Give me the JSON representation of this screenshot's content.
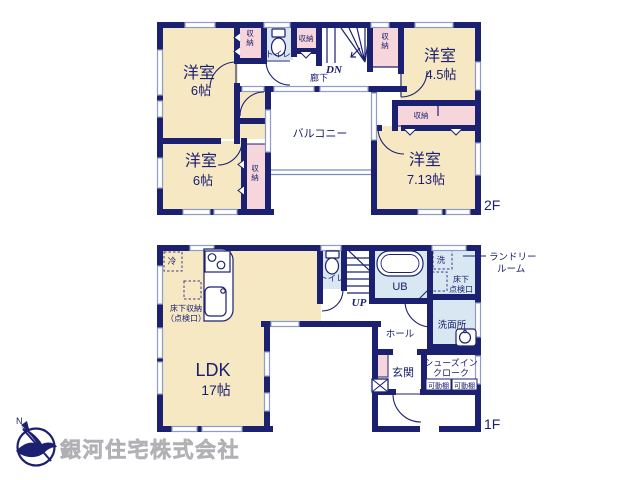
{
  "f2": {
    "floor_label": "2F",
    "bedroom": "洋室",
    "bedroom_tl_size": "6帖",
    "bedroom_bl_size": "6帖",
    "bedroom_tr_size": "4.5帖",
    "bedroom_br_size": "7.13帖",
    "balcony": "バルコニー",
    "hallway": "廊下",
    "toilet": "トイレ",
    "closet": "収納",
    "stairs_down": "DN"
  },
  "f1": {
    "floor_label": "1F",
    "ldk": "LDK",
    "ldk_size": "17帖",
    "toilet": "トイレ",
    "stairs_up": "UP",
    "unit_bath": "UB",
    "fridge": "冷",
    "washer": "洗",
    "underfloor_storage": [
      "床下収納",
      "（点検口）"
    ],
    "underfloor_hatch": [
      "床下",
      "点検口"
    ],
    "laundry_room": [
      "ランドリー",
      "ルーム"
    ],
    "washroom": "洗面所",
    "hall": "ホール",
    "entrance": "玄関",
    "shoe_closet": [
      "シューズイン",
      "クローク"
    ],
    "movable_shelf": "可動棚"
  },
  "company": {
    "name": "銀河住宅株式会社",
    "compass_n": "N"
  },
  "colors": {
    "wall": "#1c2070",
    "room_cream": "#f5e8c3",
    "storage_pink": "#f6d6da",
    "wet_blue": "#d9e7f3",
    "window": "#8f9cc9",
    "logo_text": "#c7c7cb"
  }
}
